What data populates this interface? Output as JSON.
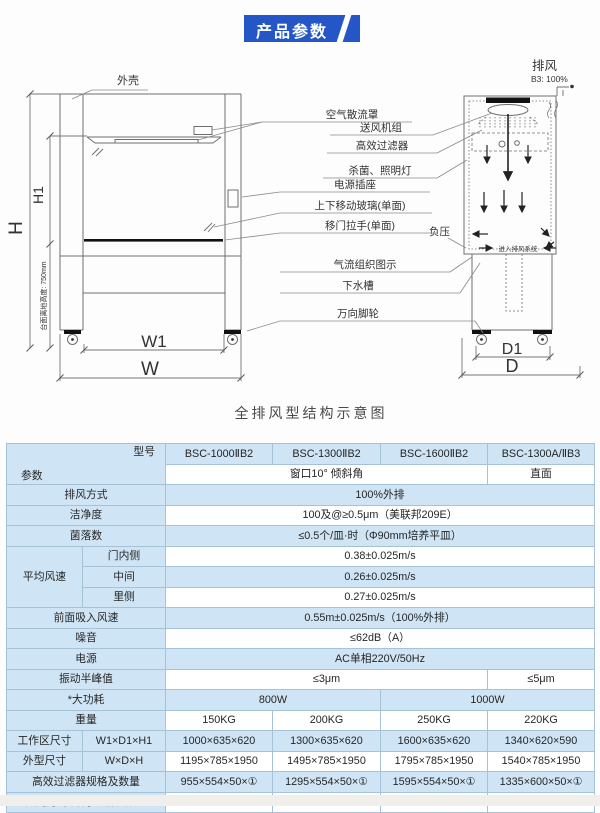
{
  "theme": {
    "badge_blue": "#2456c7",
    "table_blue": "#cfe4f4",
    "border_blue": "#a5c2d6"
  },
  "page": {
    "badge": "产品参数",
    "caption": "全排风型结构示意图"
  },
  "diagram": {
    "shell_label": "外壳",
    "exhaust_label": "排风",
    "exhaust_value": "B3: 100%",
    "negative_pressure_label": "负压",
    "enter_exhaust_label": "进入排风系统",
    "dims": {
      "h": "H",
      "h1": "H1",
      "height_note": "台面离地高度: 750mm",
      "w1": "W1",
      "w": "W",
      "d1": "D1",
      "d": "D"
    },
    "part_labels": [
      "空气散流罩",
      "送风机组",
      "高效过滤器",
      "杀菌、照明灯",
      "电源插座",
      "上下移动玻璃(单面)",
      "移门拉手(单面)",
      "气流组织图示",
      "下水槽",
      "万向脚轮"
    ]
  },
  "table": {
    "header": {
      "model_label": "型号",
      "param_label": "参数",
      "models": [
        "BSC-1000ⅡB2",
        "BSC-1300ⅡB2",
        "BSC-1600ⅡB2",
        "BSC-1300A/ⅡB3"
      ],
      "window_note": "窗口10° 倾斜角",
      "front_note": "直面"
    },
    "rows": {
      "exhaust_mode": {
        "label": "排风方式",
        "value": "100%外排"
      },
      "cleanliness": {
        "label": "洁净度",
        "value": "100及@≥0.5μm（美联邦209E）"
      },
      "colony": {
        "label": "菌落数",
        "value": "≤0.5个/皿·时（Φ90mm培养平皿）"
      },
      "avg_speed": {
        "label": "平均风速",
        "items": [
          {
            "pos": "门内侧",
            "value": "0.38±0.025m/s"
          },
          {
            "pos": "中间",
            "value": "0.26±0.025m/s"
          },
          {
            "pos": "里侧",
            "value": "0.27±0.025m/s"
          }
        ]
      },
      "front_intake": {
        "label": "前面吸入风速",
        "value": "0.55m±0.025m/s（100%外排）"
      },
      "noise": {
        "label": "噪音",
        "value": "≤62dB（A）"
      },
      "power_supply": {
        "label": "电源",
        "value": "AC单相220V/50Hz"
      },
      "vibration": {
        "label": "振动半峰值",
        "value_a": "≤3μm",
        "value_b": "≤5μm"
      },
      "max_power": {
        "label": "*大功耗",
        "value_a": "800W",
        "value_b": "1000W"
      },
      "weight": {
        "label": "重量",
        "values": [
          "150KG",
          "200KG",
          "250KG",
          "220KG"
        ]
      },
      "work_area": {
        "label": "工作区尺寸",
        "sub": "W1×D1×H1",
        "values": [
          "1000×635×620",
          "1300×635×620",
          "1600×635×620",
          "1340×620×590"
        ]
      },
      "outer_size": {
        "label": "外型尺寸",
        "sub": "W×D×H",
        "values": [
          "1195×785×1950",
          "1495×785×1950",
          "1795×785×1950",
          "1540×785×1950"
        ]
      },
      "hepa": {
        "label": "高效过滤器规格及数量",
        "values": [
          "955×554×50×①",
          "1295×554×50×①",
          "1595×554×50×①",
          "1335×600×50×①"
        ]
      },
      "lamps": {
        "label": "荧光灯/紫外灯规格及数量",
        "values": [
          "20W×①/20W×①",
          "30W×①/30W×①",
          "30W×①/30W×①",
          "30W×①/30W×①"
        ]
      }
    }
  }
}
